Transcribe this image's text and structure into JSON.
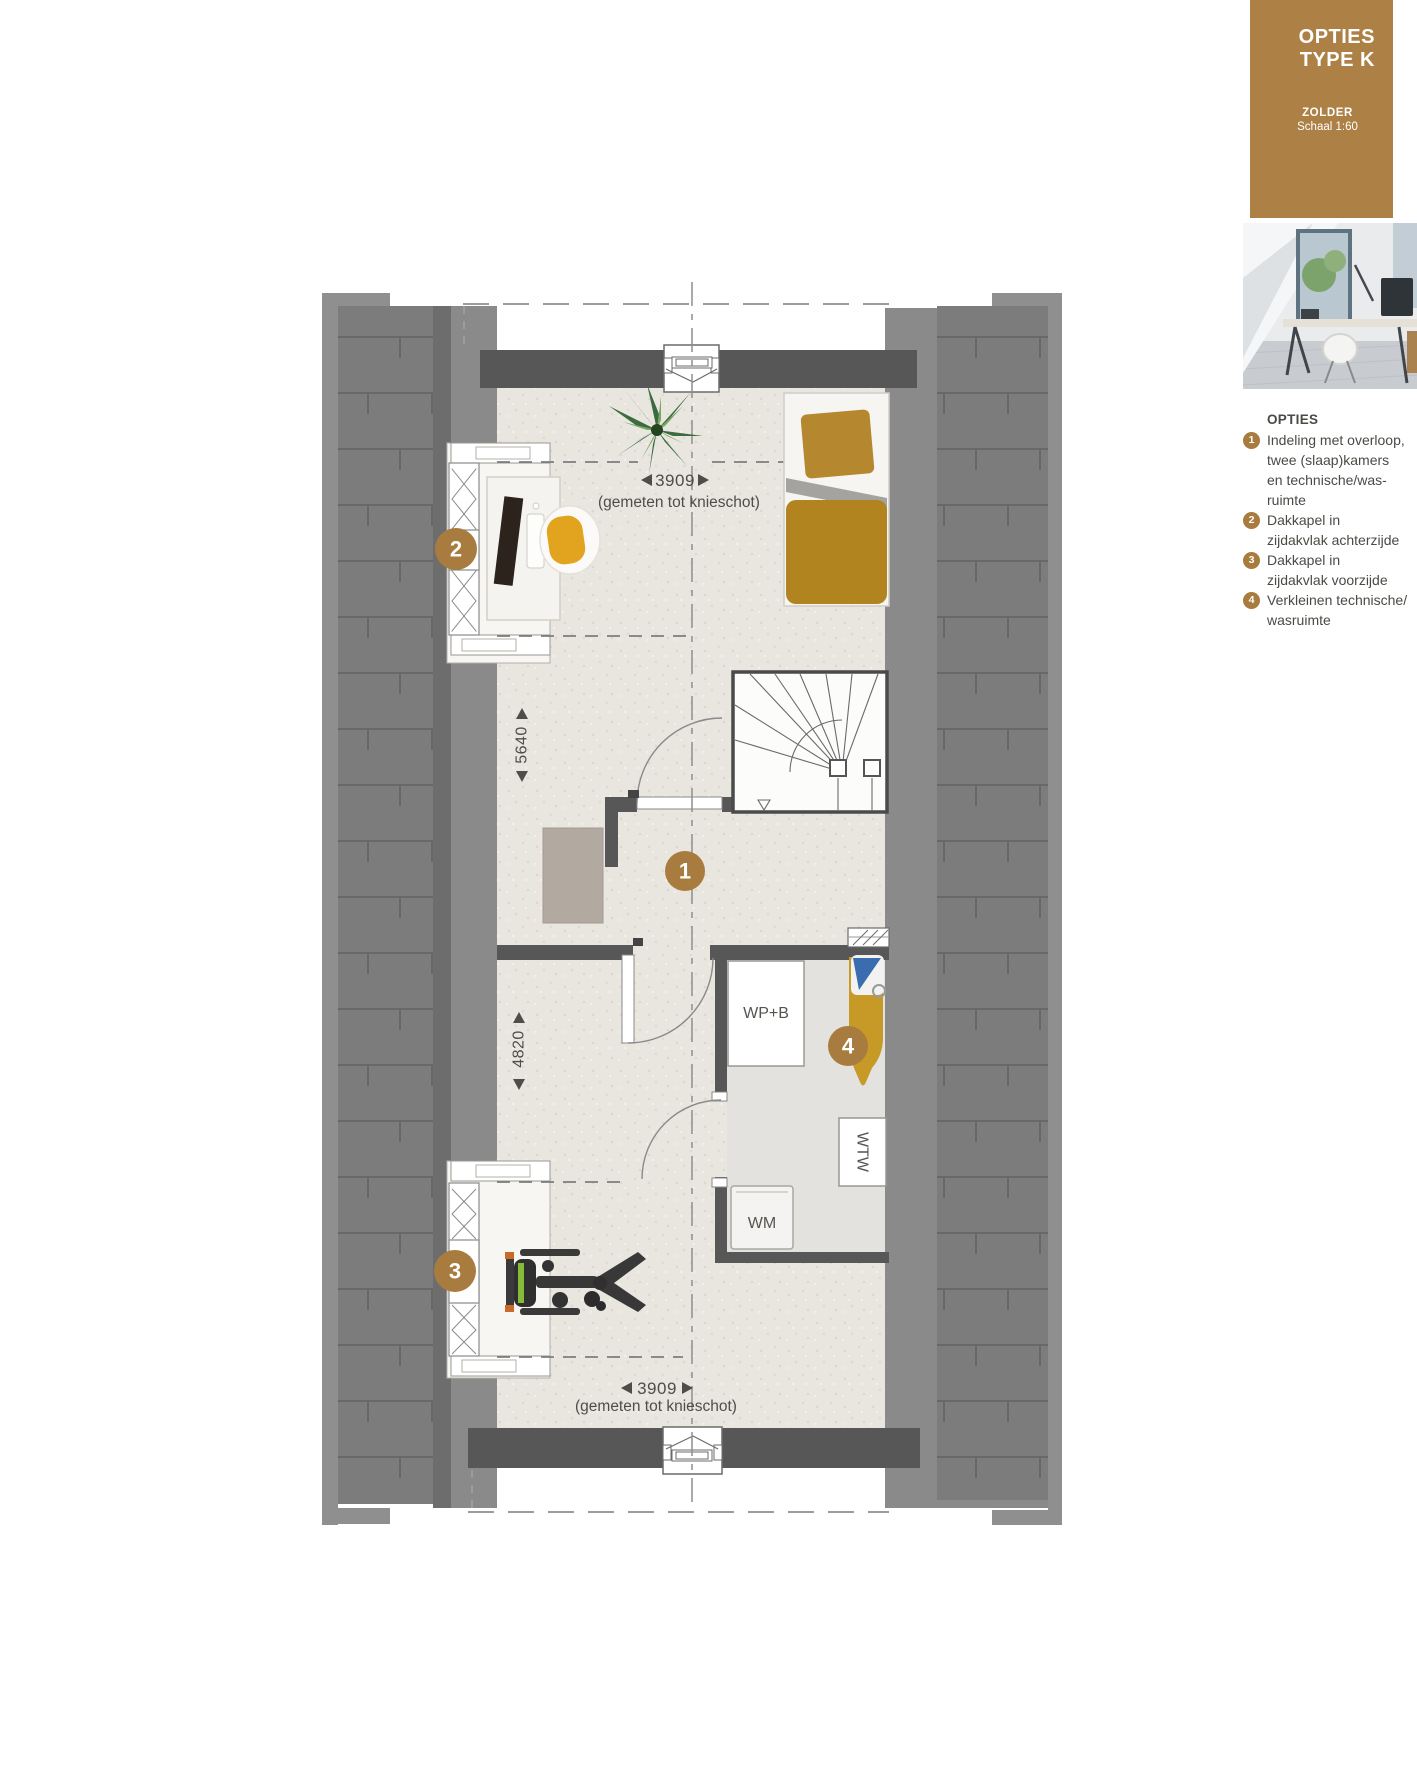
{
  "sidebar": {
    "title": [
      "OPTIES",
      "TYPE K"
    ],
    "floor_label": "ZOLDER",
    "scale_label": "Schaal 1:60",
    "legend_title": "OPTIES",
    "legend_items": [
      {
        "num": "1",
        "lines": [
          "Indeling met overloop,",
          "twee (slaap)kamers",
          "en technische/was-",
          "ruimte"
        ]
      },
      {
        "num": "2",
        "lines": [
          "Dakkapel in",
          "zijdakvlak achterzijde"
        ]
      },
      {
        "num": "3",
        "lines": [
          "Dakkapel in",
          "zijdakvlak voorzijde"
        ]
      },
      {
        "num": "4",
        "lines": [
          "Verkleinen technische/",
          "wasruimte"
        ]
      }
    ],
    "colors": {
      "accent_brown": "#ad8045"
    }
  },
  "plan": {
    "markers": [
      "1",
      "2",
      "3",
      "4"
    ],
    "rooms": {
      "heat_pump_boiler": "WP+B",
      "heat_recovery_unit": "WTW",
      "washing_machine": "WM"
    },
    "dimensions": {
      "top_width": "3909",
      "top_width_note": "(gemeten tot knieschot)",
      "bottom_width": "3909",
      "bottom_width_note": "(gemeten tot knieschot)",
      "upper_depth": "5640",
      "lower_depth": "4820"
    },
    "colors": {
      "wall_dark": "#575757",
      "roof_gray": "#7c7c7c",
      "floor_beige": "#e9e6e0",
      "marker_brown": "#a87c3e"
    }
  }
}
